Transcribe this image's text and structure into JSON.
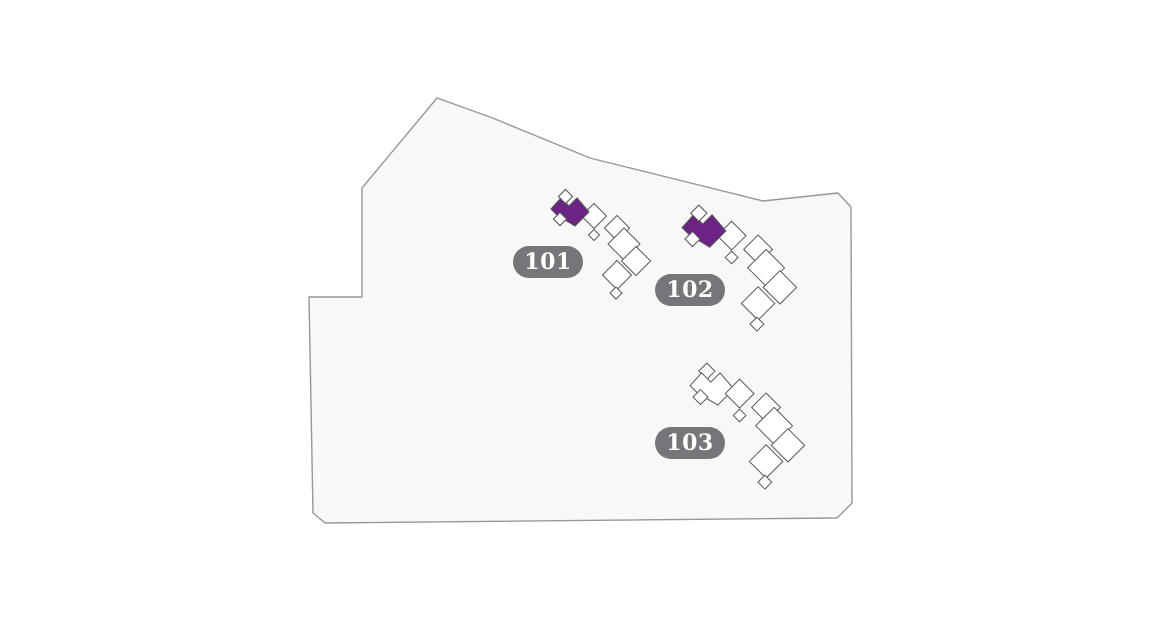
{
  "map": {
    "type": "residential-site-plan",
    "colors": {
      "background": "#ffffff",
      "parcel_fill": "#f8f8f9",
      "parcel_stroke": "#97979b",
      "building_stroke": "#57585c",
      "unit_fill": "#ffffff",
      "highlight": "#6d2384",
      "label_bg": "#76767a",
      "label_text": "#ffffff"
    },
    "buildings": [
      {
        "id": "101",
        "label": "101",
        "highlighted": true
      },
      {
        "id": "102",
        "label": "102",
        "highlighted": true
      },
      {
        "id": "103",
        "label": "103",
        "highlighted": false
      }
    ]
  }
}
